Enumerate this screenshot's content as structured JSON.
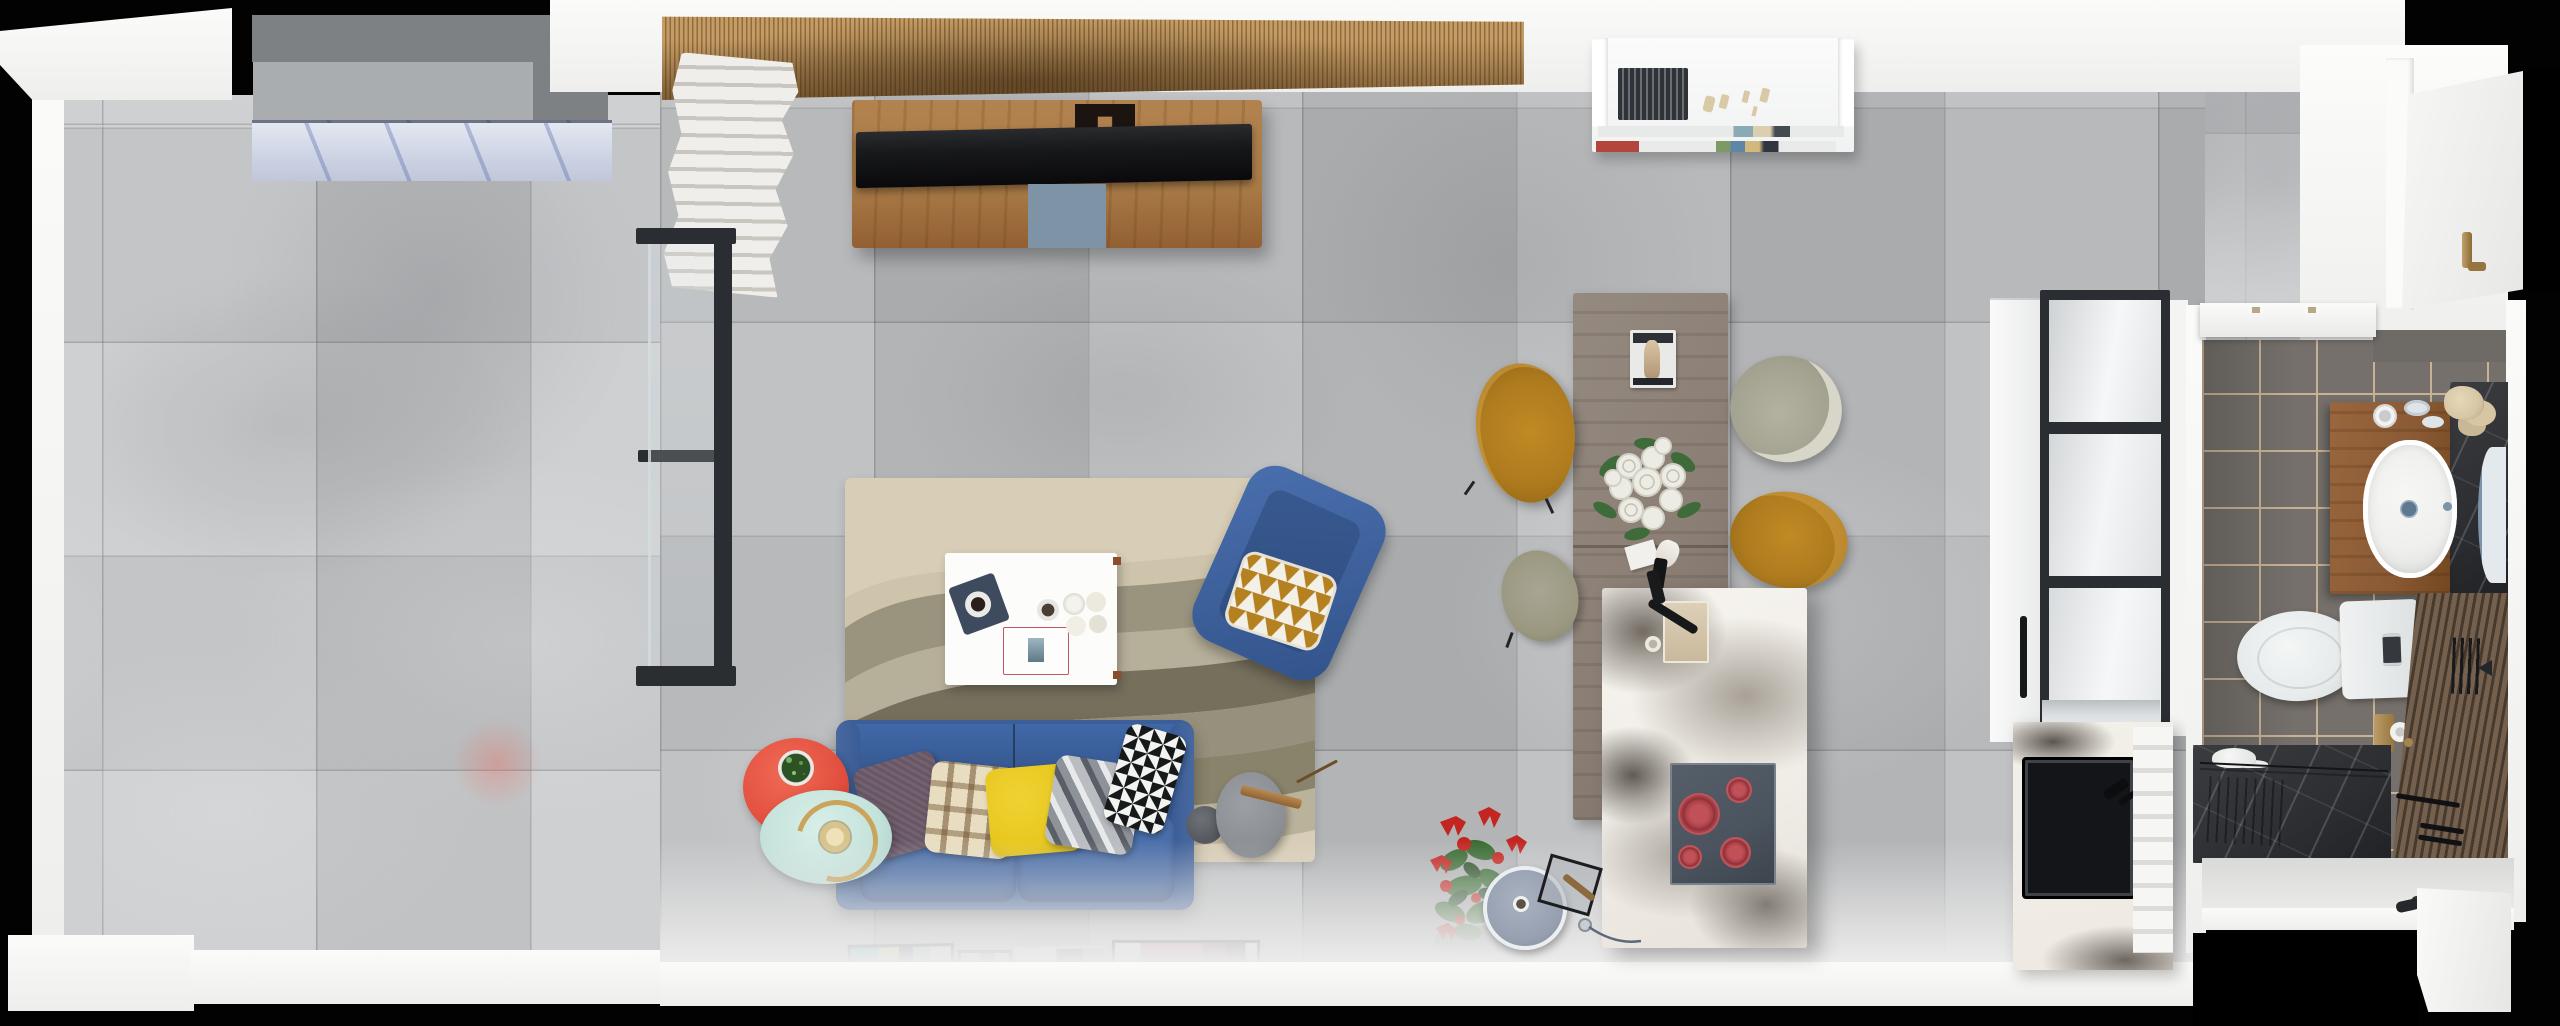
{
  "scene": {
    "label": "Top-down 3D render of a studio apartment floor plan",
    "width_px": 2560,
    "height_px": 1026,
    "view": "orthographic top view, photorealistic"
  },
  "palette": {
    "void": "#020202",
    "wall_white": "#f5f5f3",
    "tile_living": "#b9bbbd",
    "tile_balcony": "#c7c9cb",
    "slat_wood_light": "#c59c64",
    "slat_wood_dark": "#8f6c40",
    "console_wood": "#a87a46",
    "tv_black": "#17181a",
    "tv_mat_blue": "#7e93a6",
    "radiator_white": "#efeeea",
    "shelf_white": "#f1f2f2",
    "book_red": "#b4453c",
    "figurine_beige": "#d9c9a4",
    "glass_frame_black": "#2a2d32",
    "planter_dark": "#7e8183",
    "planter_light": "#a9adb0",
    "canopy_glass": "#ccd3e3",
    "rug_base": "#d8cdb6",
    "rug_wave_olive": "#8f8a76",
    "rug_wave_dark": "#5d5846",
    "rug_wave_light": "#b3ac96",
    "coffee_table_white": "#fcfcfb",
    "tray_navy": "#3e4a5e",
    "sofa_blue": "#3c5f99",
    "sofa_blue_dark": "#35568c",
    "sofa_seat_blue": "#466ba6",
    "pillow_plum": "#685665",
    "pillow_cream": "#e9ddc1",
    "pillow_yellow": "#e7c71e",
    "armchair_gold": "#b5801f",
    "side_table_red": "#e4503f",
    "side_table_mint": "#c3e2da",
    "lamp_gold": "#caa45a",
    "lamp_disc_gray": "#8c9095",
    "plant_red": "#c32521",
    "plant_green": "#3a6b33",
    "dining_wood": "#8b7f75",
    "chair_mustard": "#ad7a1e",
    "chair_olive": "#a3a18f",
    "chair_olive_light": "#d8d6c8",
    "island_marble": "#f1eee8",
    "cooktop_slate": "#4b545e",
    "burner_red": "#a93f47",
    "cabinet_white": "#f0f1f1",
    "sink_black": "#141518",
    "counter_marble": "#eee9e2",
    "bath_floor": "#75706b",
    "bath_grout": "#c8b295",
    "vanity_wood": "#8a5a35",
    "fixture_white": "#eff0ee",
    "towel_beige": "#d6c6a4",
    "marble_dark": "#2c2e31",
    "slat_bath_light": "#74604d",
    "slat_bath_dark": "#463a2e",
    "door_white": "#f7f7f6",
    "handle_gold": "#a5854f",
    "mirror_blue": "#7c93a8"
  },
  "rooms": [
    {
      "name": "balcony",
      "label": "Balcony"
    },
    {
      "name": "living-room",
      "label": "Living room"
    },
    {
      "name": "dining-area",
      "label": "Dining area"
    },
    {
      "name": "kitchen",
      "label": "Kitchen"
    },
    {
      "name": "bathroom",
      "label": "Bathroom"
    },
    {
      "name": "entry",
      "label": "Entry"
    }
  ],
  "furniture": {
    "canopy": {
      "label": "Balcony glass canopy and planter"
    },
    "radiator": {
      "label": "White sculptural radiator"
    },
    "tv_console": {
      "label": "Wood TV console with flat-screen TV"
    },
    "media_shelf": {
      "label": "White shelf with books and figurines"
    },
    "sliding_door": {
      "label": "Black-framed glass sliding door"
    },
    "rug": {
      "label": "Abstract beige-olive area rug"
    },
    "coffee_table": {
      "label": "White coffee table with navy tray, book and roses"
    },
    "armchair": {
      "label": "Blue armchair with gold triangle cushion"
    },
    "sofa": {
      "label": "Blue two-seat sofa with five cushions"
    },
    "side_tables": {
      "label": "Red and mint side tables with brass lamp"
    },
    "floor_lamp": {
      "label": "Gray disc floor lamp"
    },
    "floor_plant": {
      "label": "Red flowering plant"
    },
    "wall_art": {
      "label": "Four framed artworks leaning on wall"
    },
    "dining_table": {
      "label": "Gray-walnut dining table"
    },
    "dining_chairs": {
      "label": "Two mustard and two olive dining chairs"
    },
    "bouquet": {
      "label": "White rose bouquet"
    },
    "magazine": {
      "label": "Magazine on dining table"
    },
    "island": {
      "label": "White marble kitchen island"
    },
    "cooktop": {
      "label": "Four-zone cooktop with red burners"
    },
    "stool": {
      "label": "Blue-gray swivel stool and magazine rack"
    },
    "tall_cabinet": {
      "label": "Tall cabinet with black-framed glass doors"
    },
    "sink_counter": {
      "label": "Marble counter with black sink"
    },
    "bath_shelf": {
      "label": "White wall cabinet"
    },
    "vanity": {
      "label": "Walnut vanity with oval basin and mirror"
    },
    "towels": {
      "label": "Beige and white towels"
    },
    "toilet": {
      "label": "Toilet with tank"
    },
    "tp_holder": {
      "label": "Brass toilet-paper holder"
    },
    "shower": {
      "label": "Dark marble shower area with black fixtures"
    },
    "entry_door": {
      "label": "Open white entry door with brass handle"
    },
    "slippers": {
      "label": "Slippers at entry"
    }
  }
}
